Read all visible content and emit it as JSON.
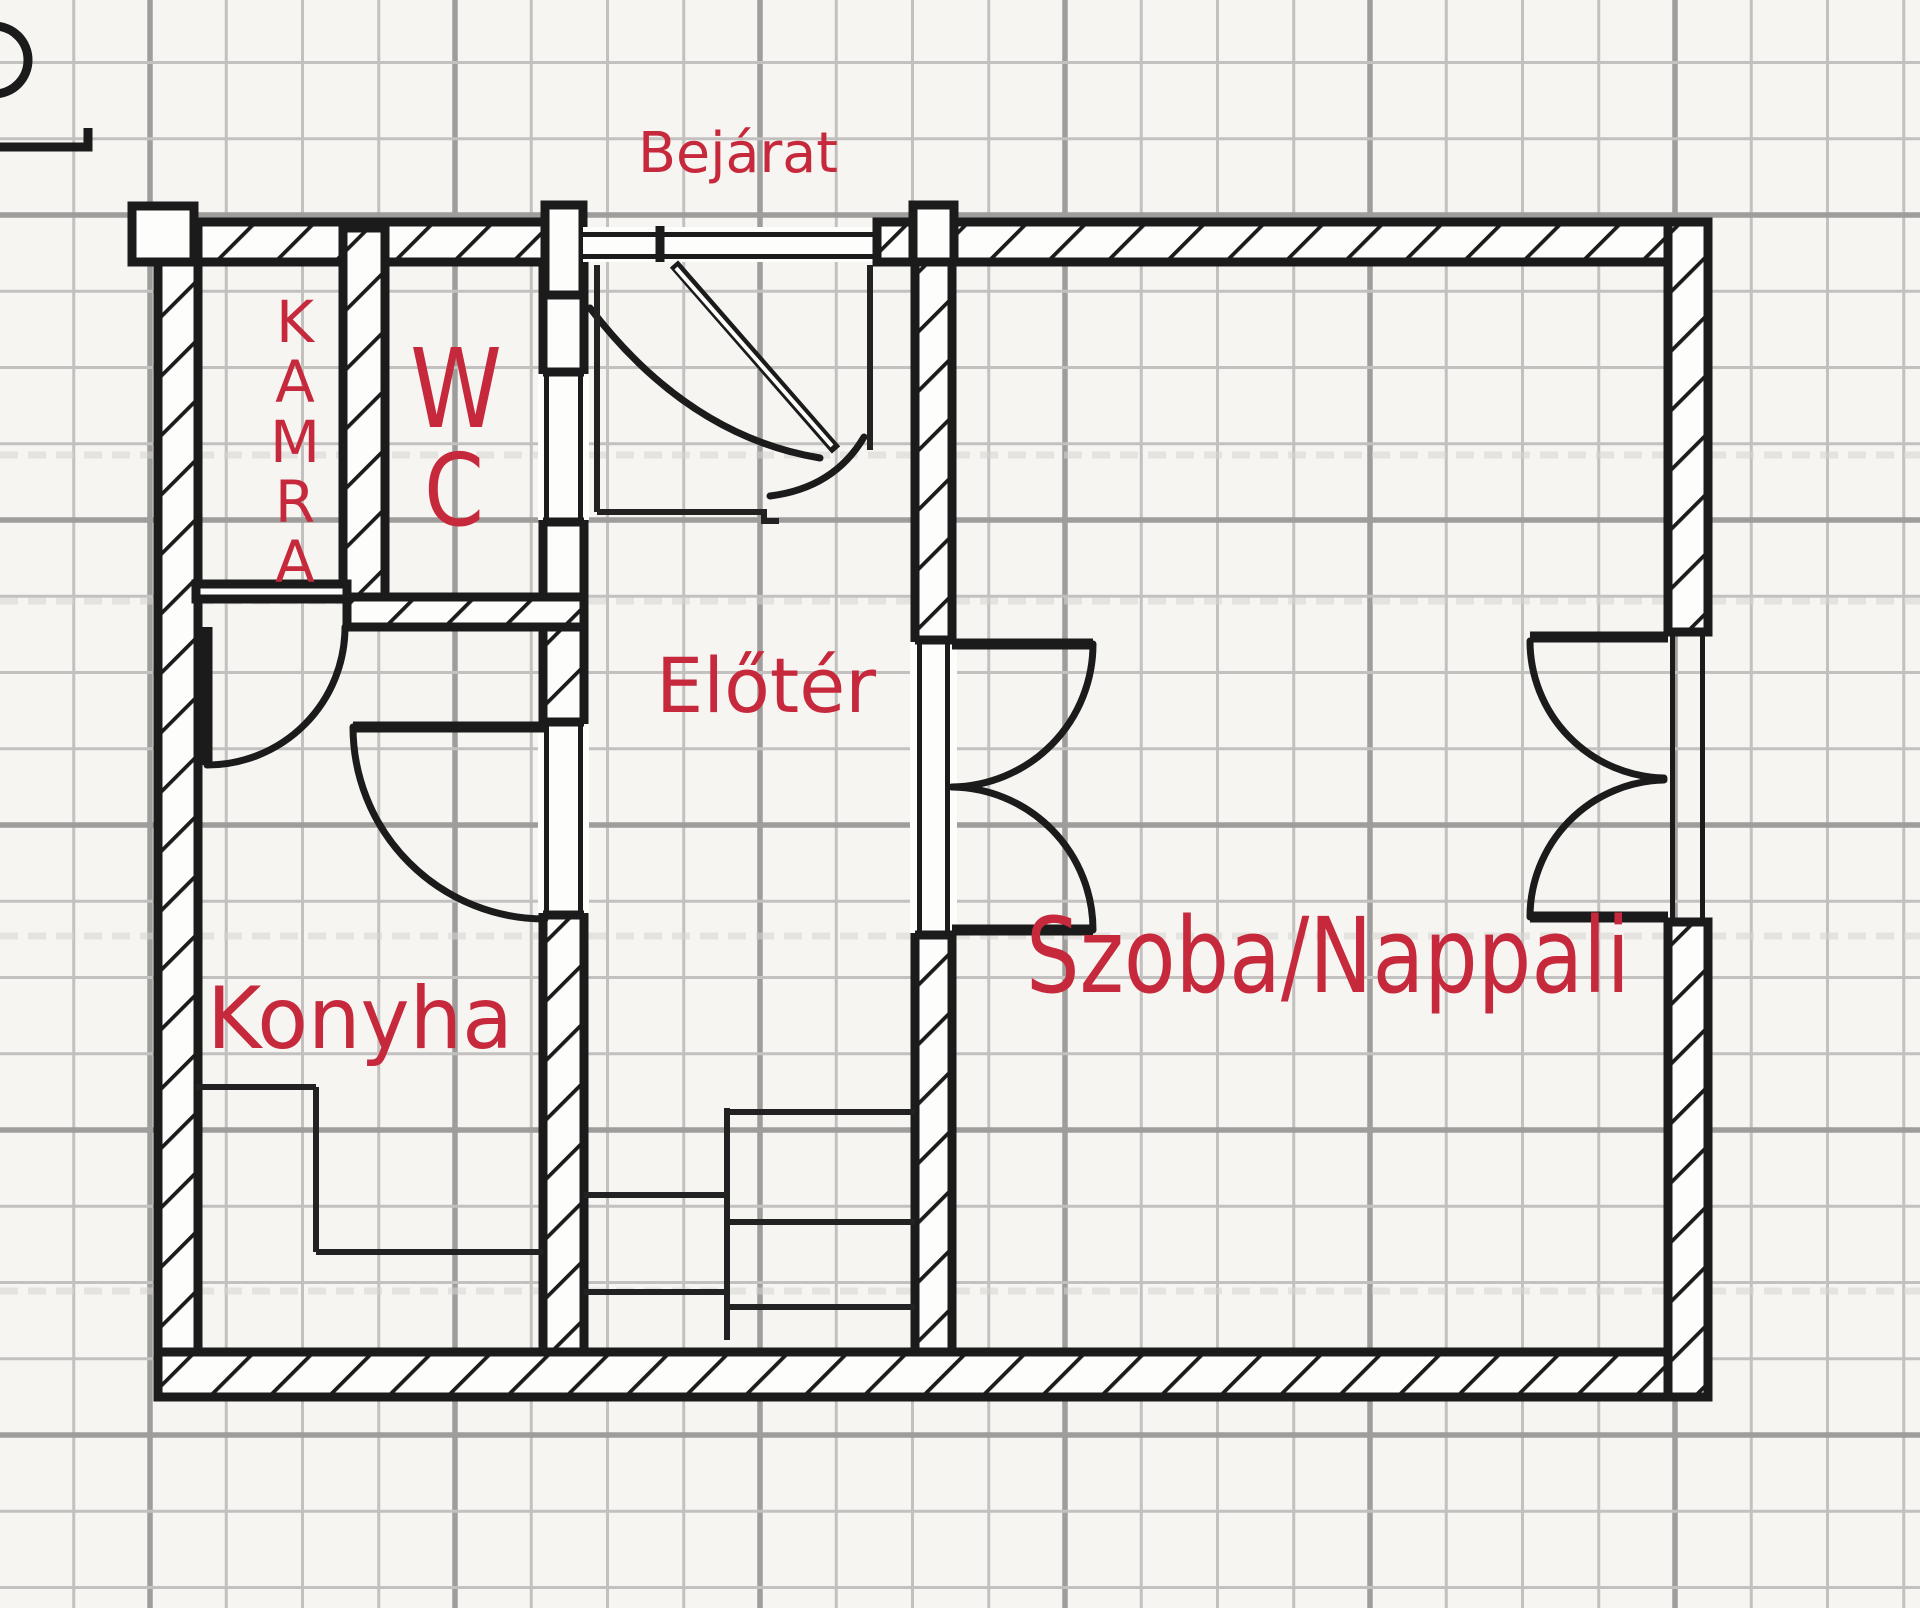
{
  "plan": {
    "type": "floor-plan",
    "language": "Hungarian",
    "labels": {
      "entrance": "Bejárat",
      "pantry_letters": [
        "K",
        "A",
        "M",
        "R",
        "A"
      ],
      "wc_lines": [
        "W",
        "C"
      ],
      "hall": "Előtér",
      "kitchen": "Konyha",
      "living_room": "Szoba/Nappali"
    },
    "rooms": [
      {
        "id": "kamra",
        "label": "KAMRA",
        "kind": "pantry"
      },
      {
        "id": "wc",
        "label": "WC",
        "kind": "toilet"
      },
      {
        "id": "elotér",
        "label": "Előtér",
        "kind": "hall"
      },
      {
        "id": "konyha",
        "label": "Konyha",
        "kind": "kitchen"
      },
      {
        "id": "szoba",
        "label": "Szoba/Nappali",
        "kind": "living-room"
      }
    ]
  },
  "colors": {
    "label_red": "#c7293c",
    "wall": "#1b1b1b",
    "thin": "#222222",
    "bg": "#f6f5f2",
    "grid_minor": "#c2c1bf",
    "grid_major": "#9e9d9b",
    "watermark": "#d6d5d3"
  }
}
